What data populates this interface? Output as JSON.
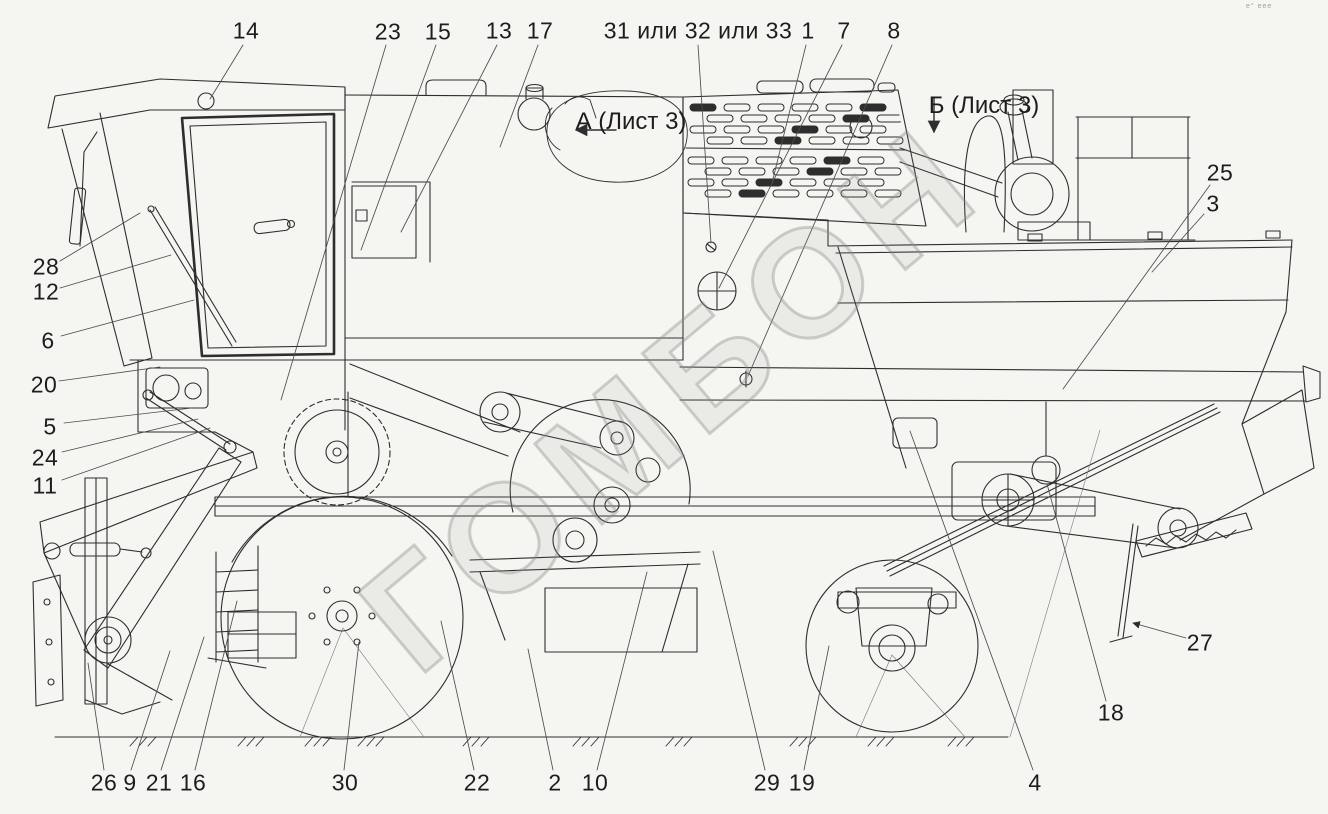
{
  "figure": {
    "type": "parts-diagram",
    "subject": "combine harvester side view line drawing",
    "background_color": "#f5f6f2",
    "line_color": "#2e2e2e",
    "label_color": "#1d1d1d"
  },
  "callouts": [
    {
      "text": "14"
    },
    {
      "text": "23"
    },
    {
      "text": "15"
    },
    {
      "text": "13"
    },
    {
      "text": "17"
    },
    {
      "text": "31 или 32 или 33"
    },
    {
      "text": "1"
    },
    {
      "text": "7"
    },
    {
      "text": "8"
    },
    {
      "text": "25"
    },
    {
      "text": "3"
    },
    {
      "text": "28"
    },
    {
      "text": "12"
    },
    {
      "text": "6"
    },
    {
      "text": "20"
    },
    {
      "text": "5"
    },
    {
      "text": "24"
    },
    {
      "text": "11"
    },
    {
      "text": "26"
    },
    {
      "text": "9"
    },
    {
      "text": "21"
    },
    {
      "text": "16"
    },
    {
      "text": "30"
    },
    {
      "text": "22"
    },
    {
      "text": "2"
    },
    {
      "text": "10"
    },
    {
      "text": "29"
    },
    {
      "text": "19"
    },
    {
      "text": "4"
    },
    {
      "text": "18"
    },
    {
      "text": "27"
    }
  ],
  "annotations": {
    "view_a": "А (Лист 3)",
    "view_b": "Б (Лист 3)"
  },
  "watermark": {
    "text": "ГОМБОН"
  },
  "corner_marks": "е° еее"
}
